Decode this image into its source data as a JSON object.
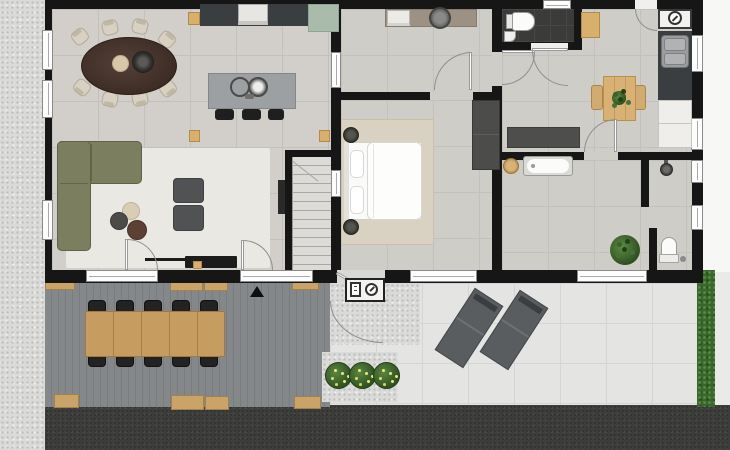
{
  "document": {
    "type": "architectural-floor-plan",
    "view": "top-down",
    "content": "single-storey dwelling with deck terrace, patio, garden strip"
  },
  "palette": {
    "wall": "#161616",
    "floor_tile": "#cfcdc8",
    "wc_floor": "#3b3b39",
    "living_rug": "#eae8e2",
    "bedroom_rug": "#d9d1c1",
    "sofa_olive": "#7b7e5f",
    "wood_light": "#c9a368",
    "island_gray": "#9da0a2",
    "counter_dark": "#3b3e41",
    "fridge_sage": "#a9bcab",
    "utility_counter": "#9d9183",
    "deck_gray": "#84878b",
    "gravel": "#dadad8",
    "patio_tile": "#e4e4e2",
    "asphalt": "#3d3d3b",
    "hedge_green": "#3a652e",
    "bush_green": "#2f5122",
    "flower_yellow": "#e8e87f",
    "lounger_gray": "#5a5d60",
    "door_arc": "#8f8f8f"
  },
  "symbols": {
    "entrance_marker": "black-triangle",
    "front_door_panel": [
      "fuse-box-icon",
      "circle-arrow-icon"
    ],
    "utility_wall_box": [
      "circle-arrow-icon"
    ]
  },
  "rooms": [
    {
      "name": "living-dining-kitchen",
      "furniture": [
        "oval dining table",
        "8 dining chairs",
        "candle plate",
        "dark bowl",
        "kitchen island with 2 round sinks",
        "3 black bar stools",
        "wall counter with oven",
        "sage fridge cabinet",
        "olive corner sofa",
        "2 gray armchairs",
        "3 round coffee tables",
        "tv cabinet with soundbar",
        "wall tv",
        "wood stools"
      ]
    },
    {
      "name": "staircase",
      "details": "straight stair, ~12 treads"
    },
    {
      "name": "utility-room",
      "furniture": [
        "taupe counter",
        "round basin",
        "white appliance"
      ]
    },
    {
      "name": "bedroom",
      "furniture": [
        "double bed with duvet",
        "2 pillows",
        "2 round nightstands",
        "area rug",
        "dark wardrobe"
      ]
    },
    {
      "name": "wc",
      "furniture": [
        "toilet",
        "corner basin"
      ],
      "floor": "dark tile"
    },
    {
      "name": "hallway",
      "furniture": [
        "dark sideboard",
        "wood bench"
      ]
    },
    {
      "name": "kitchenette-dining",
      "furniture": [
        "square wood table",
        "2 wood chairs",
        "table plant",
        "steel sink counter",
        "white base cabinets",
        "meter box"
      ]
    },
    {
      "name": "bathroom",
      "furniture": [
        "bathtub",
        "round wood stool",
        "walk-in shower with partial wall",
        "toilet",
        "green plant"
      ]
    },
    {
      "name": "deck-terrace",
      "furniture": [
        "long plank table",
        "10 black chairs",
        "pergola beams"
      ]
    },
    {
      "name": "patio",
      "furniture": [
        "2 sun loungers",
        "planter with 3 flowering bushes"
      ]
    }
  ],
  "counts": {
    "dining_chairs": 8,
    "bar_stools": 3,
    "outdoor_chairs": 10,
    "sun_loungers": 2,
    "flower_bushes": 3,
    "left_wall_windows": 3,
    "bottom_wall_windows": 4,
    "right_wall_windows": 4
  }
}
